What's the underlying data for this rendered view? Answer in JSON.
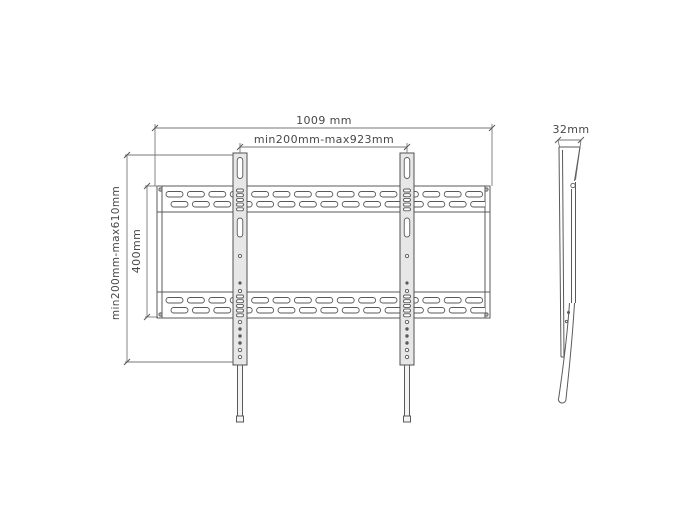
{
  "drawing": {
    "type": "tv-wall-mount-technical-drawing",
    "line_color": "#595a5c",
    "background_color": "#ffffff"
  },
  "front_view": {
    "total_width_label": "1009 mm",
    "vesa_width_label": "min200mm-max923mm",
    "height_range_label": "min200mm-max610mm",
    "vesa_height_label": "400mm",
    "rail_slot_columns": 15,
    "rail_slot_rows_per_rail": 2,
    "arm_count": 2,
    "arm_ladder_slots": 5,
    "arm_lower_hole_count": 6
  },
  "side_view": {
    "depth_label": "32mm"
  }
}
